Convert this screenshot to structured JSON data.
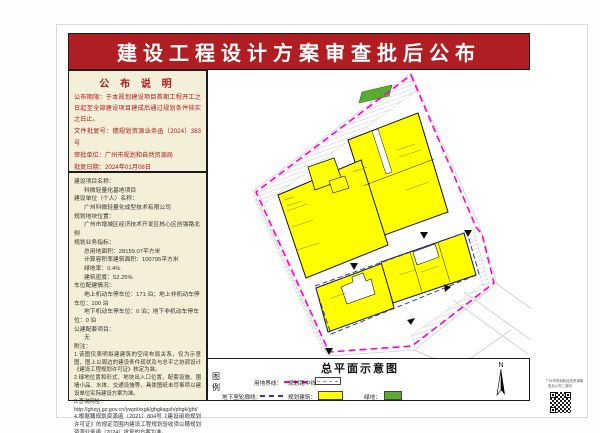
{
  "banner": {
    "title": "建设工程设计方案审查批后公布",
    "bg_color": "#b01e23"
  },
  "notice_panel": {
    "title": "公 布 说 明",
    "lines": [
      "公布期限：于本规划建设项目首期工程开工之日起至全部建设项目建成后通过规划条件核实之日止。",
      "文件批复号：穗规划资源业务函〔2024〕383号",
      "审批单位：广州市规划和自然资源局",
      "批复日期：2024年01月08日"
    ]
  },
  "info_panel": {
    "lines": [
      "建设项目名称：",
      "科微轻量化基地项目",
      "建设单位（个人）名称：",
      "广州科微轻量化成型技术有限公司",
      "规划地块位置：",
      "广州市增城区经济技术开发区核心区创强路北侧",
      "规划业务指标：",
      "总用地面积：28159.07平方米",
      "计算容积率建筑面积：100795平方米",
      "绿地率：0.4%",
      "建筑密度：52.25%",
      "车位配建情况：",
      "地上机动车停车位：171 泊；地上非机动车停车位：100 泊",
      "地下机动车停车位：0 泊；地下非机动车停车位：0 泊",
      "公建配套项目：",
      "无",
      "附注：",
      "1.该图仅表明拟建建筑的空间布局关系，仅为示意图，图上以周边的建设条件现状及与总平之协调设计《建设工程规划许可证》核定为准。",
      "2.绿地位置和形式、地块出入口位置、配套设施、围墙小品、水体、交通设施等，具体图纸未尽事项以建设单位实际建设方案为准。",
      "3.查询网址：",
      "http://ghzyj.gz.gov.cn/ywpt/xxgk/ghgksgsh/phgk/ght/",
      "4.根据穗规划资源函〔2021〕804号《建设用地规划许可证》的规定范围内建设工程规划验收须以穗规划资源业务函〔2024〕批复的方案为准。"
    ]
  },
  "site_plan": {
    "title": "总平面示意图",
    "legend_label_top": "图",
    "legend_label_bottom": "例",
    "legend": {
      "boundary": "用地界线：",
      "road_centerline": "规划路中线：",
      "underground": "地下室轮廓线：",
      "building": "规划建筑：",
      "green": "绿地："
    },
    "compass_label": "N",
    "colors": {
      "boundary_magenta": "#ff00cc",
      "underground_blue": "#2a35c8",
      "building_yellow": "#ffff00",
      "green": "#56ad2e"
    }
  },
  "qr": {
    "caption1": "广州市规划和自然资源局",
    "caption2": "批后公布二维码"
  }
}
